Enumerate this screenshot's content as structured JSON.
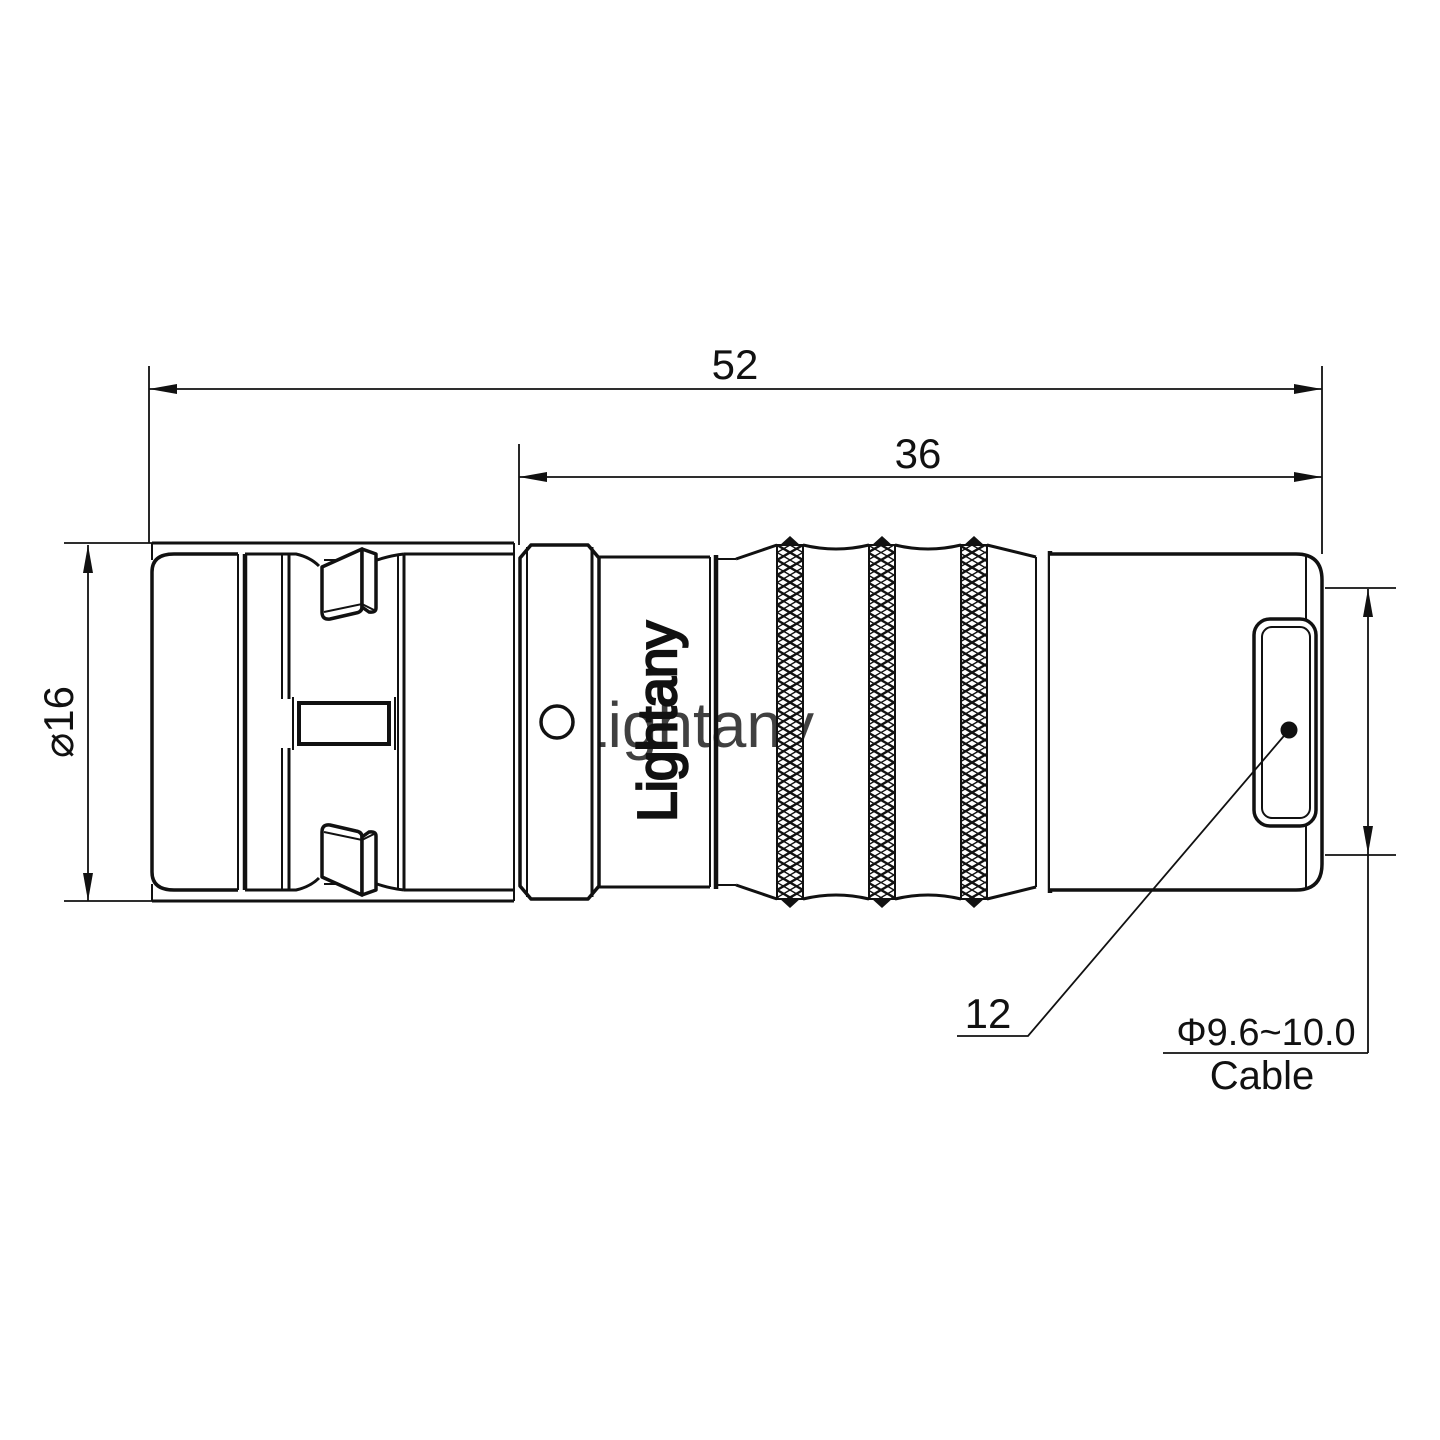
{
  "drawing": {
    "title": "connector-outline-drawing",
    "colors": {
      "line": "#111111",
      "background": "#ffffff",
      "watermark": "#e59999"
    },
    "watermark_text": "Lightany",
    "brand_text": "Lightany",
    "dims": {
      "overall_length": "52",
      "body_length": "36",
      "front_diameter": "⌀16",
      "part_number": "12",
      "cable_range": "Φ9.6~10.0",
      "cable_word": "Cable"
    }
  }
}
